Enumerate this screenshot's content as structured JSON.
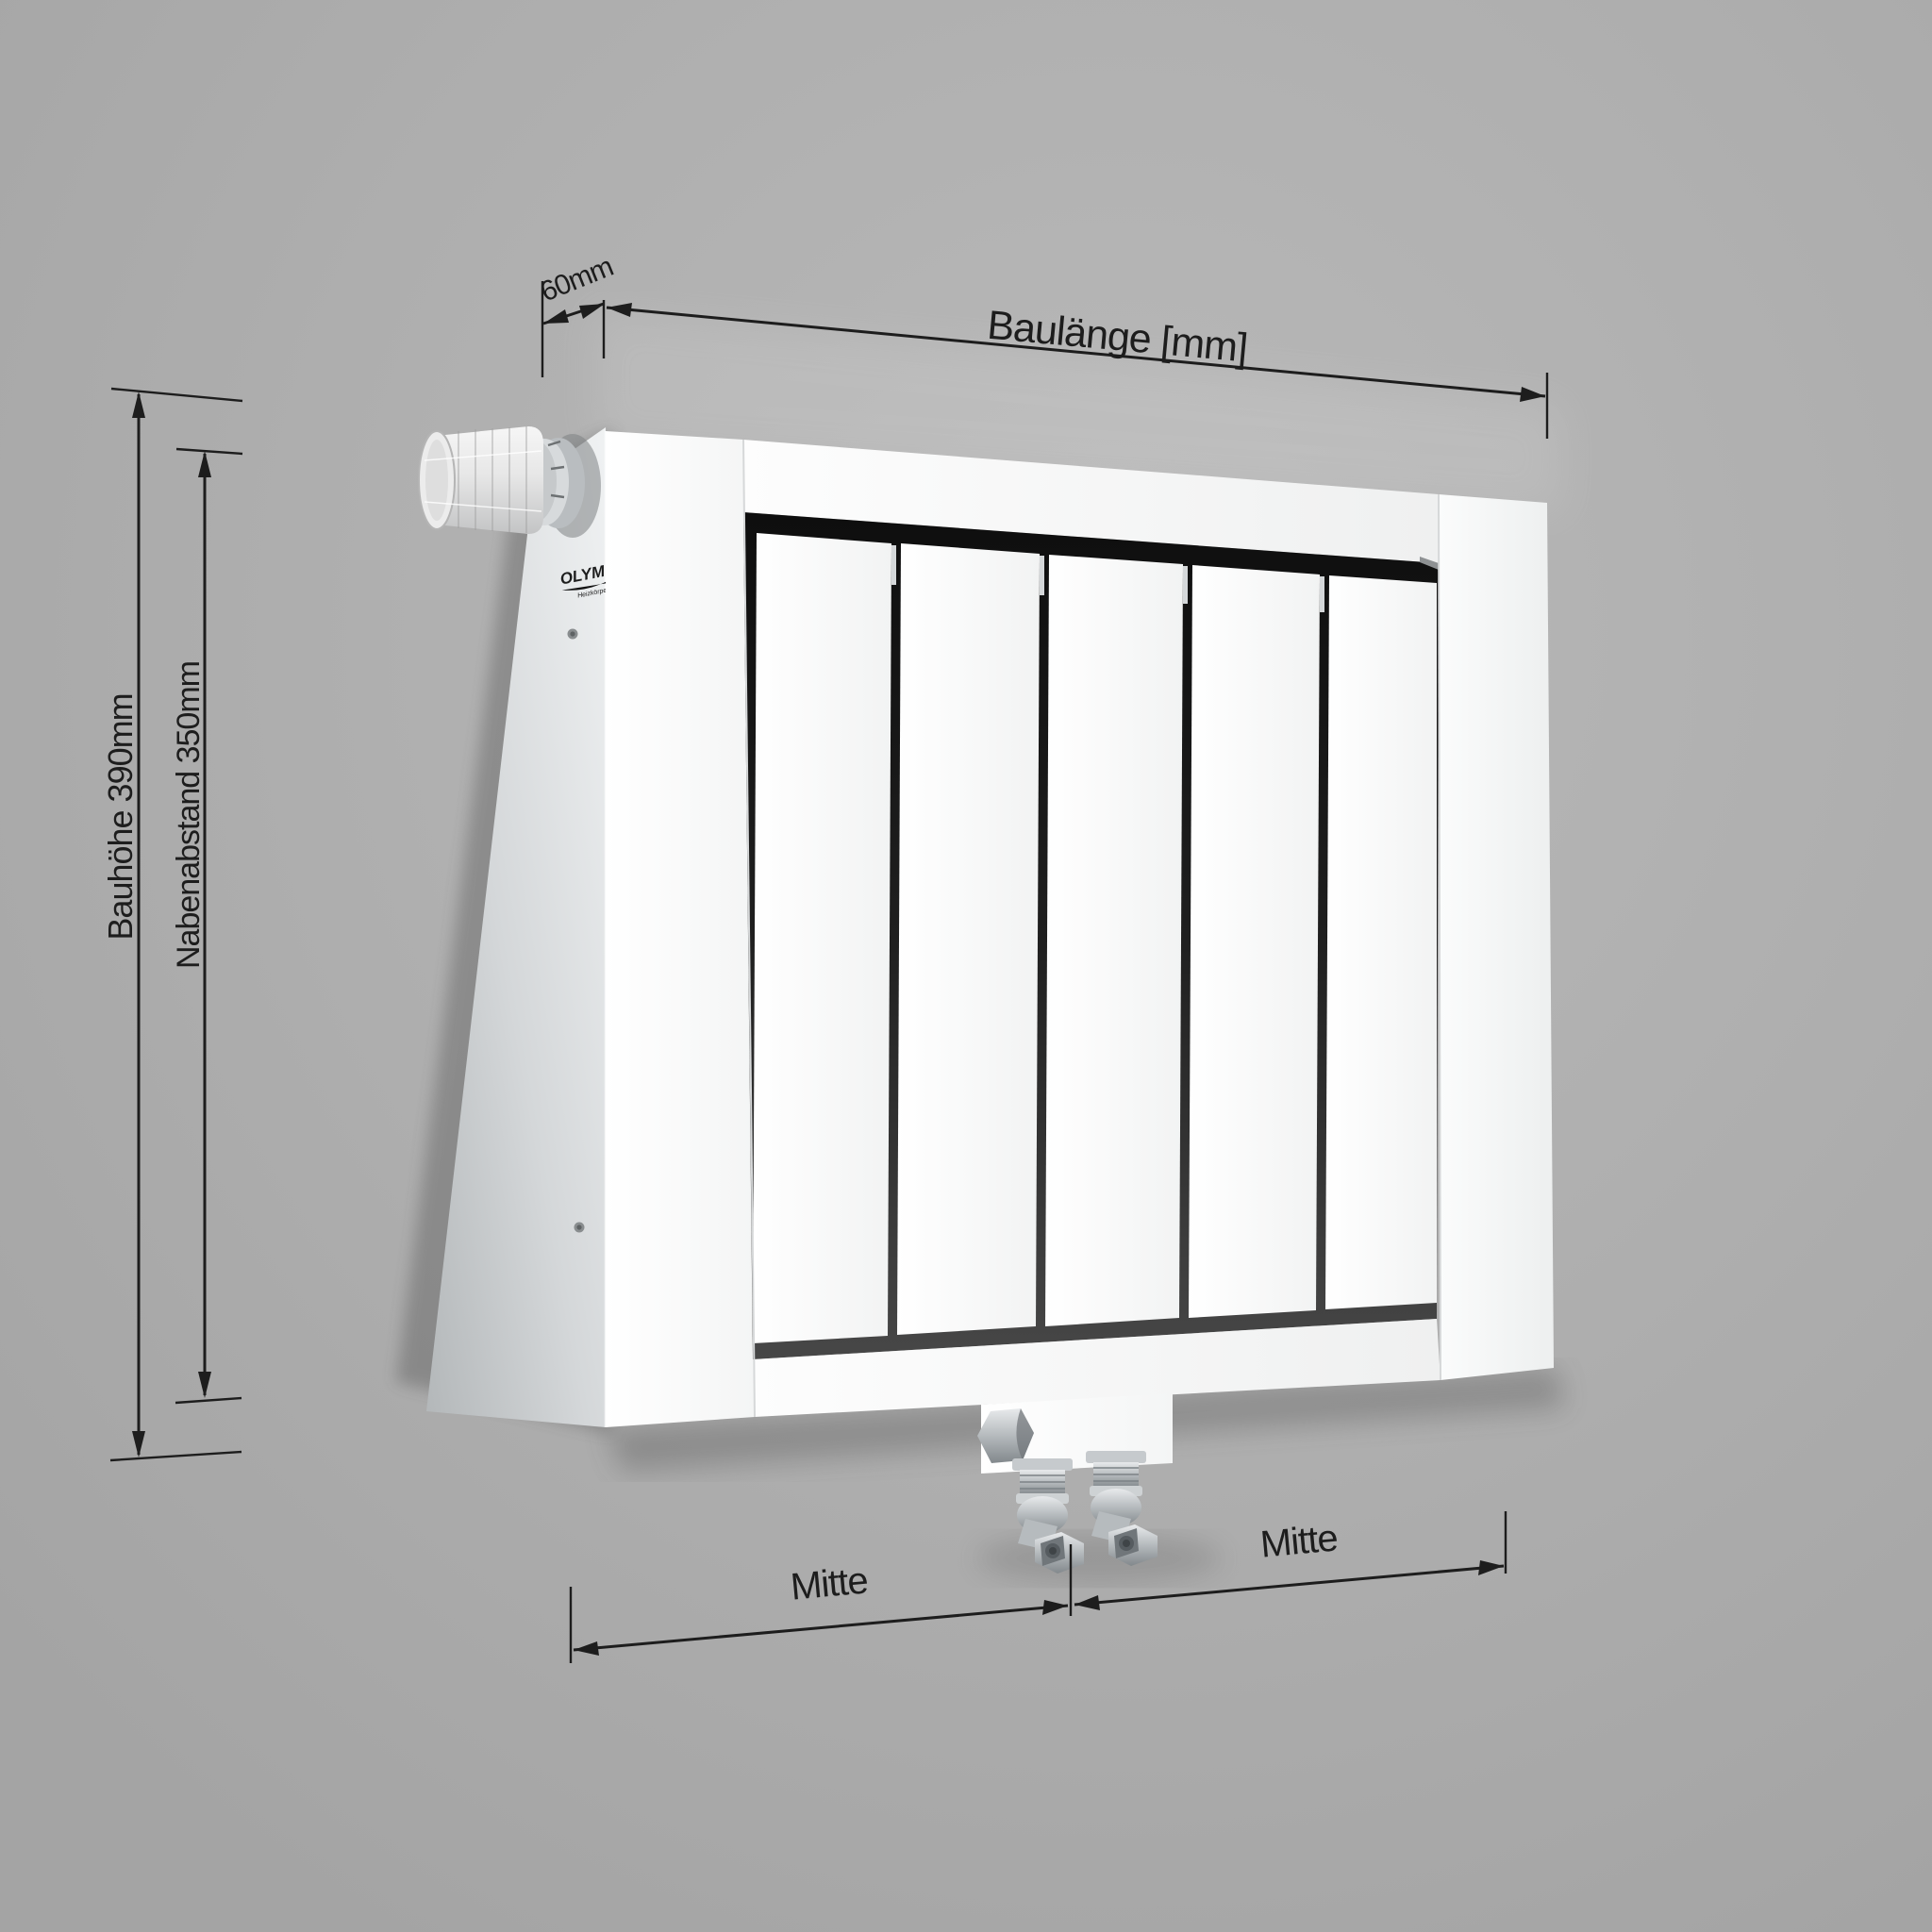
{
  "scene": {
    "description": "3D technical illustration of a white flat panel radiator with thermostat head and bottom center connection valves, with dimension lines",
    "background_color": "#adadad",
    "line_color": "#1d1d1d",
    "radiator_color": "#fbfbfb",
    "inset_dark_color": "#1a1a1a",
    "chrome_color": "#9aa0a4"
  },
  "brand": {
    "name": "OLYMP",
    "subtitle": "Heizkörper"
  },
  "dimensions": {
    "depth_label": "60mm",
    "length_label": "Baulänge [mm]",
    "height_label": "Bauhöhe 390mm",
    "hub_label": "Nabenabstand 350mm",
    "center_left_label": "Mitte",
    "center_right_label": "Mitte"
  }
}
